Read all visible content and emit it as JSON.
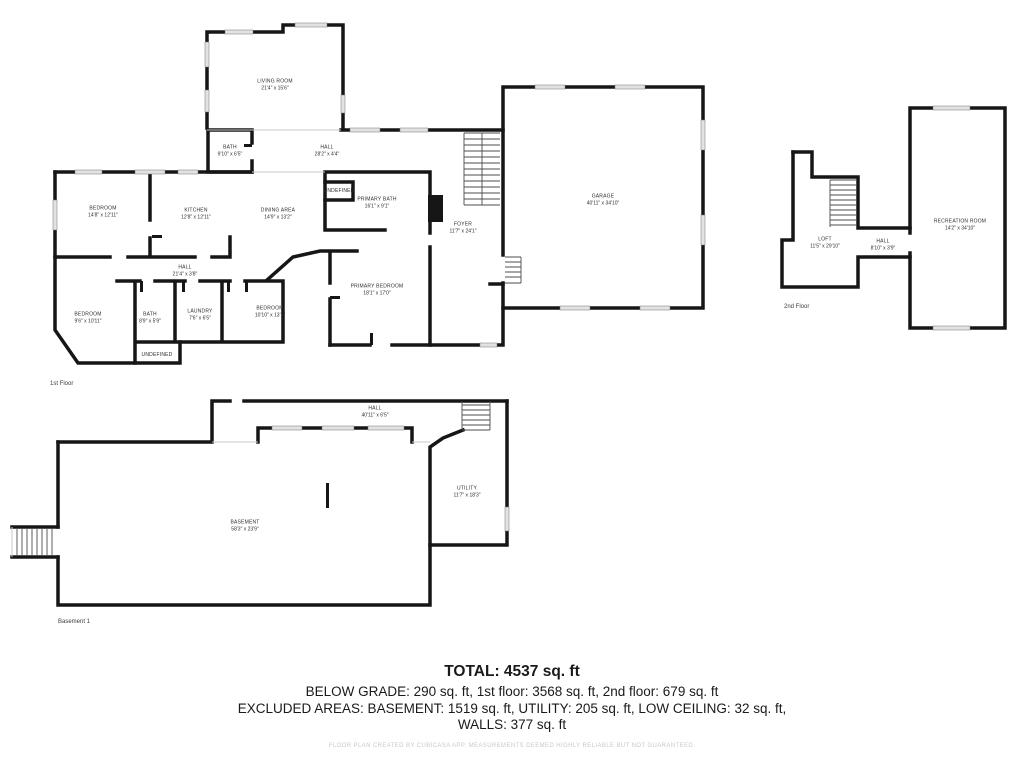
{
  "colors": {
    "wall": "#161616",
    "window": "#e2e2e2",
    "text": "#1a1a1a",
    "muted": "#c9c9c9"
  },
  "summary": {
    "total": "TOTAL: 4537 sq. ft",
    "below_grade_line": "BELOW GRADE: 290 sq. ft, 1st floor: 3568 sq. ft, 2nd floor: 679 sq. ft",
    "excluded_line": "EXCLUDED AREAS: BASEMENT: 1519 sq. ft, UTILITY: 205 sq. ft, LOW CEILING: 32 sq. ft,",
    "walls_line": "WALLS: 377 sq. ft"
  },
  "footer": {
    "disclaimer": "FLOOR PLAN CREATED BY CUBICASA APP. MEASUREMENTS DEEMED HIGHLY RELIABLE BUT NOT GUARANTEED."
  },
  "floors": {
    "first": {
      "caption": "1st Floor",
      "rooms": {
        "living_room": {
          "name": "LIVING ROOM",
          "dims": "21'4\" x 15'6\""
        },
        "bath_upper": {
          "name": "BATH",
          "dims": "9'10\" x 6'5\""
        },
        "hall_upper": {
          "name": "HALL",
          "dims": "28'2\" x 4'4\""
        },
        "bedroom_left": {
          "name": "BEDROOM",
          "dims": "14'8\" x 12'11\""
        },
        "kitchen": {
          "name": "KITCHEN",
          "dims": "12'8\" x 12'11\""
        },
        "dining_area": {
          "name": "DINING AREA",
          "dims": "14'9\" x 13'2\""
        },
        "undefined_mid": {
          "name": "UNDEFINED",
          "dims": ""
        },
        "primary_bath": {
          "name": "PRIMARY BATH",
          "dims": "16'1\" x 9'1\""
        },
        "foyer": {
          "name": "FOYER",
          "dims": "11'7\" x 24'1\""
        },
        "hall_lower": {
          "name": "HALL",
          "dims": "21'4\" x 3'8\""
        },
        "bedroom_sw": {
          "name": "BEDROOM",
          "dims": "9'6\" x 10'11\""
        },
        "bath_lower": {
          "name": "BATH",
          "dims": "8'9\" x 5'9\""
        },
        "laundry": {
          "name": "LAUNDRY",
          "dims": "7'6\" x 6'5\""
        },
        "bedroom_s": {
          "name": "BEDROOM",
          "dims": "10'10\" x 13'1\""
        },
        "primary_bedroom": {
          "name": "PRIMARY BEDROOM",
          "dims": "18'1\" x 17'0\""
        },
        "undefined_lower": {
          "name": "UNDEFINED",
          "dims": ""
        },
        "garage": {
          "name": "GARAGE",
          "dims": "40'11\" x 34'10\""
        }
      }
    },
    "second": {
      "caption": "2nd Floor",
      "rooms": {
        "loft": {
          "name": "LOFT",
          "dims": "11'5\" x 29'10\""
        },
        "hall": {
          "name": "HALL",
          "dims": "8'10\" x 3'9\""
        },
        "recreation_room": {
          "name": "RECREATION ROOM",
          "dims": "14'2\" x 34'10\""
        }
      }
    },
    "basement": {
      "caption": "Basement 1",
      "rooms": {
        "hall": {
          "name": "HALL",
          "dims": "40'11\" x 6'5\""
        },
        "basement": {
          "name": "BASEMENT",
          "dims": "58'3\" x 23'9\""
        },
        "utility": {
          "name": "UTILITY",
          "dims": "11'7\" x 18'3\""
        }
      }
    }
  }
}
